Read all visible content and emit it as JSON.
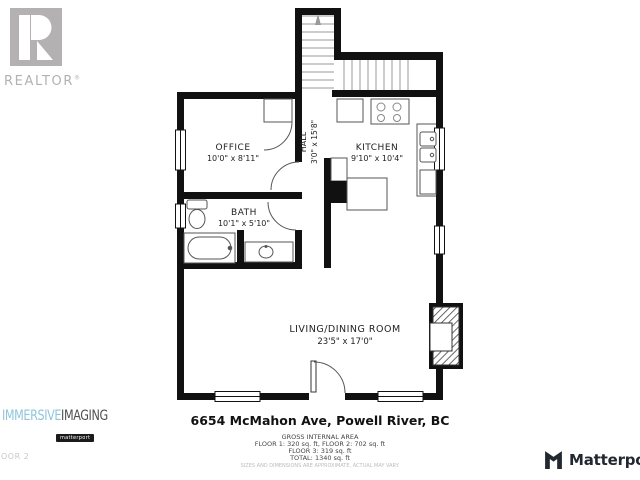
{
  "branding": {
    "realtor_logo": "REALTOR",
    "realtor_reg": "®",
    "immersive": "IMMERSIVE",
    "imaging": "IMAGING",
    "partner_badge": "matterport",
    "matterport_wordmark": "Matterport"
  },
  "floor_label_partial": "OOR 2",
  "address": "6654 McMahon Ave, Powell River, BC",
  "area_summary": {
    "title": "GROSS INTERNAL AREA",
    "line1": "FLOOR 1: 320 sq. ft, FLOOR 2: 702 sq. ft",
    "line2": "FLOOR 3: 319 sq. ft",
    "total": "TOTAL: 1340 sq. ft",
    "disclaimer": "SIZES AND DIMENSIONS ARE APPROXIMATE, ACTUAL MAY VARY."
  },
  "rooms": {
    "office": {
      "name": "OFFICE",
      "dims": "10'0\" x 8'11\""
    },
    "hall": {
      "name": "HALL",
      "dims": "3'0\" x 15'8\""
    },
    "kitchen": {
      "name": "KITCHEN",
      "dims": "9'10\" x 10'4\""
    },
    "bath": {
      "name": "BATH",
      "dims": "10'1\" x 5'10\""
    },
    "living_dining": {
      "name": "LIVING/DINING ROOM",
      "dims": "23'5\" x 17'0\""
    }
  },
  "colors": {
    "wall": "#111111",
    "logo_gray": "#b3b1b1",
    "immersive_blue": "#8ec6da",
    "matterport_dark": "#222831",
    "faint_text": "#c9c9c9"
  }
}
